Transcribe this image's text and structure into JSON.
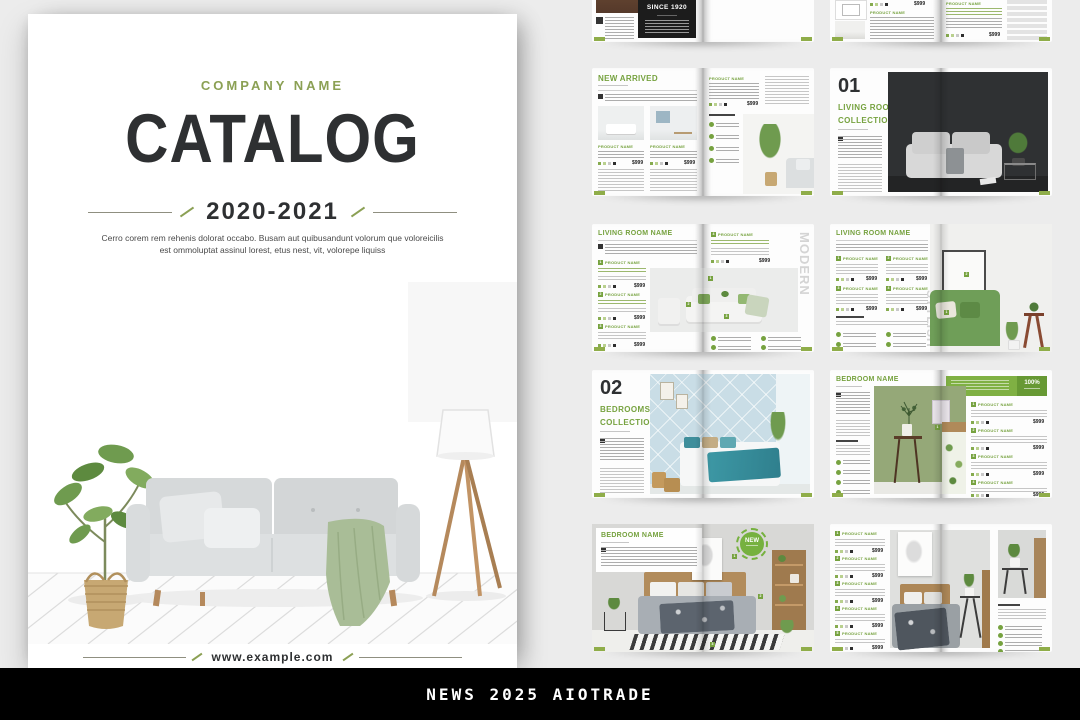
{
  "colors": {
    "accent_green": "#76a23f",
    "tab_green": "#8fad49",
    "olive": "#8ba054",
    "dark_text": "#2e3032"
  },
  "cover": {
    "company_name": "COMPANY NAME",
    "title": "CATALOG",
    "years": "2020-2021",
    "description": "Cerro corem rem rehenis dolorat occabo. Busam aut quibusandunt volorum que voloreicilis est ommoluptat assinul lorest, etus nest, vit, volorepe liquiss",
    "website": "www.example.com"
  },
  "footer": {
    "text": "NEWS 2025 AIOTRADE"
  },
  "labels": {
    "one": "1",
    "two": "2",
    "three": "3",
    "four": "4",
    "five": "5"
  },
  "spreads": {
    "intro": {
      "since_badge": "SINCE 1920"
    },
    "products_intro": {
      "product": "PRODUCT NAME",
      "price": "$999"
    },
    "new_arrived": {
      "title": "NEW ARRIVED",
      "product": "PRODUCT NAME",
      "price": "$999"
    },
    "living_collection": {
      "number": "01",
      "title1": "LIVING ROOMS",
      "title2": "COLLECTION"
    },
    "living_room_1": {
      "title": "LIVING ROOM NAME",
      "product": "PRODUCT NAME",
      "price": "$999",
      "vertical": "MODERN"
    },
    "living_room_2": {
      "title": "LIVING ROOM NAME",
      "product": "PRODUCT NAME",
      "price": "$999",
      "vertical": "STYLISH"
    },
    "bedrooms_collection": {
      "number": "02",
      "title1": "BEDROOMS",
      "title2": "COLLECTION"
    },
    "bedroom_1": {
      "title": "BEDROOM NAME",
      "badge_percent": "100%",
      "product": "PRODUCT NAME",
      "price": "$999"
    },
    "bedroom_2": {
      "title": "BEDROOM NAME",
      "badge_new": "NEW"
    },
    "bedroom_products": {
      "product": "PRODUCT NAME",
      "price": "$999"
    }
  }
}
